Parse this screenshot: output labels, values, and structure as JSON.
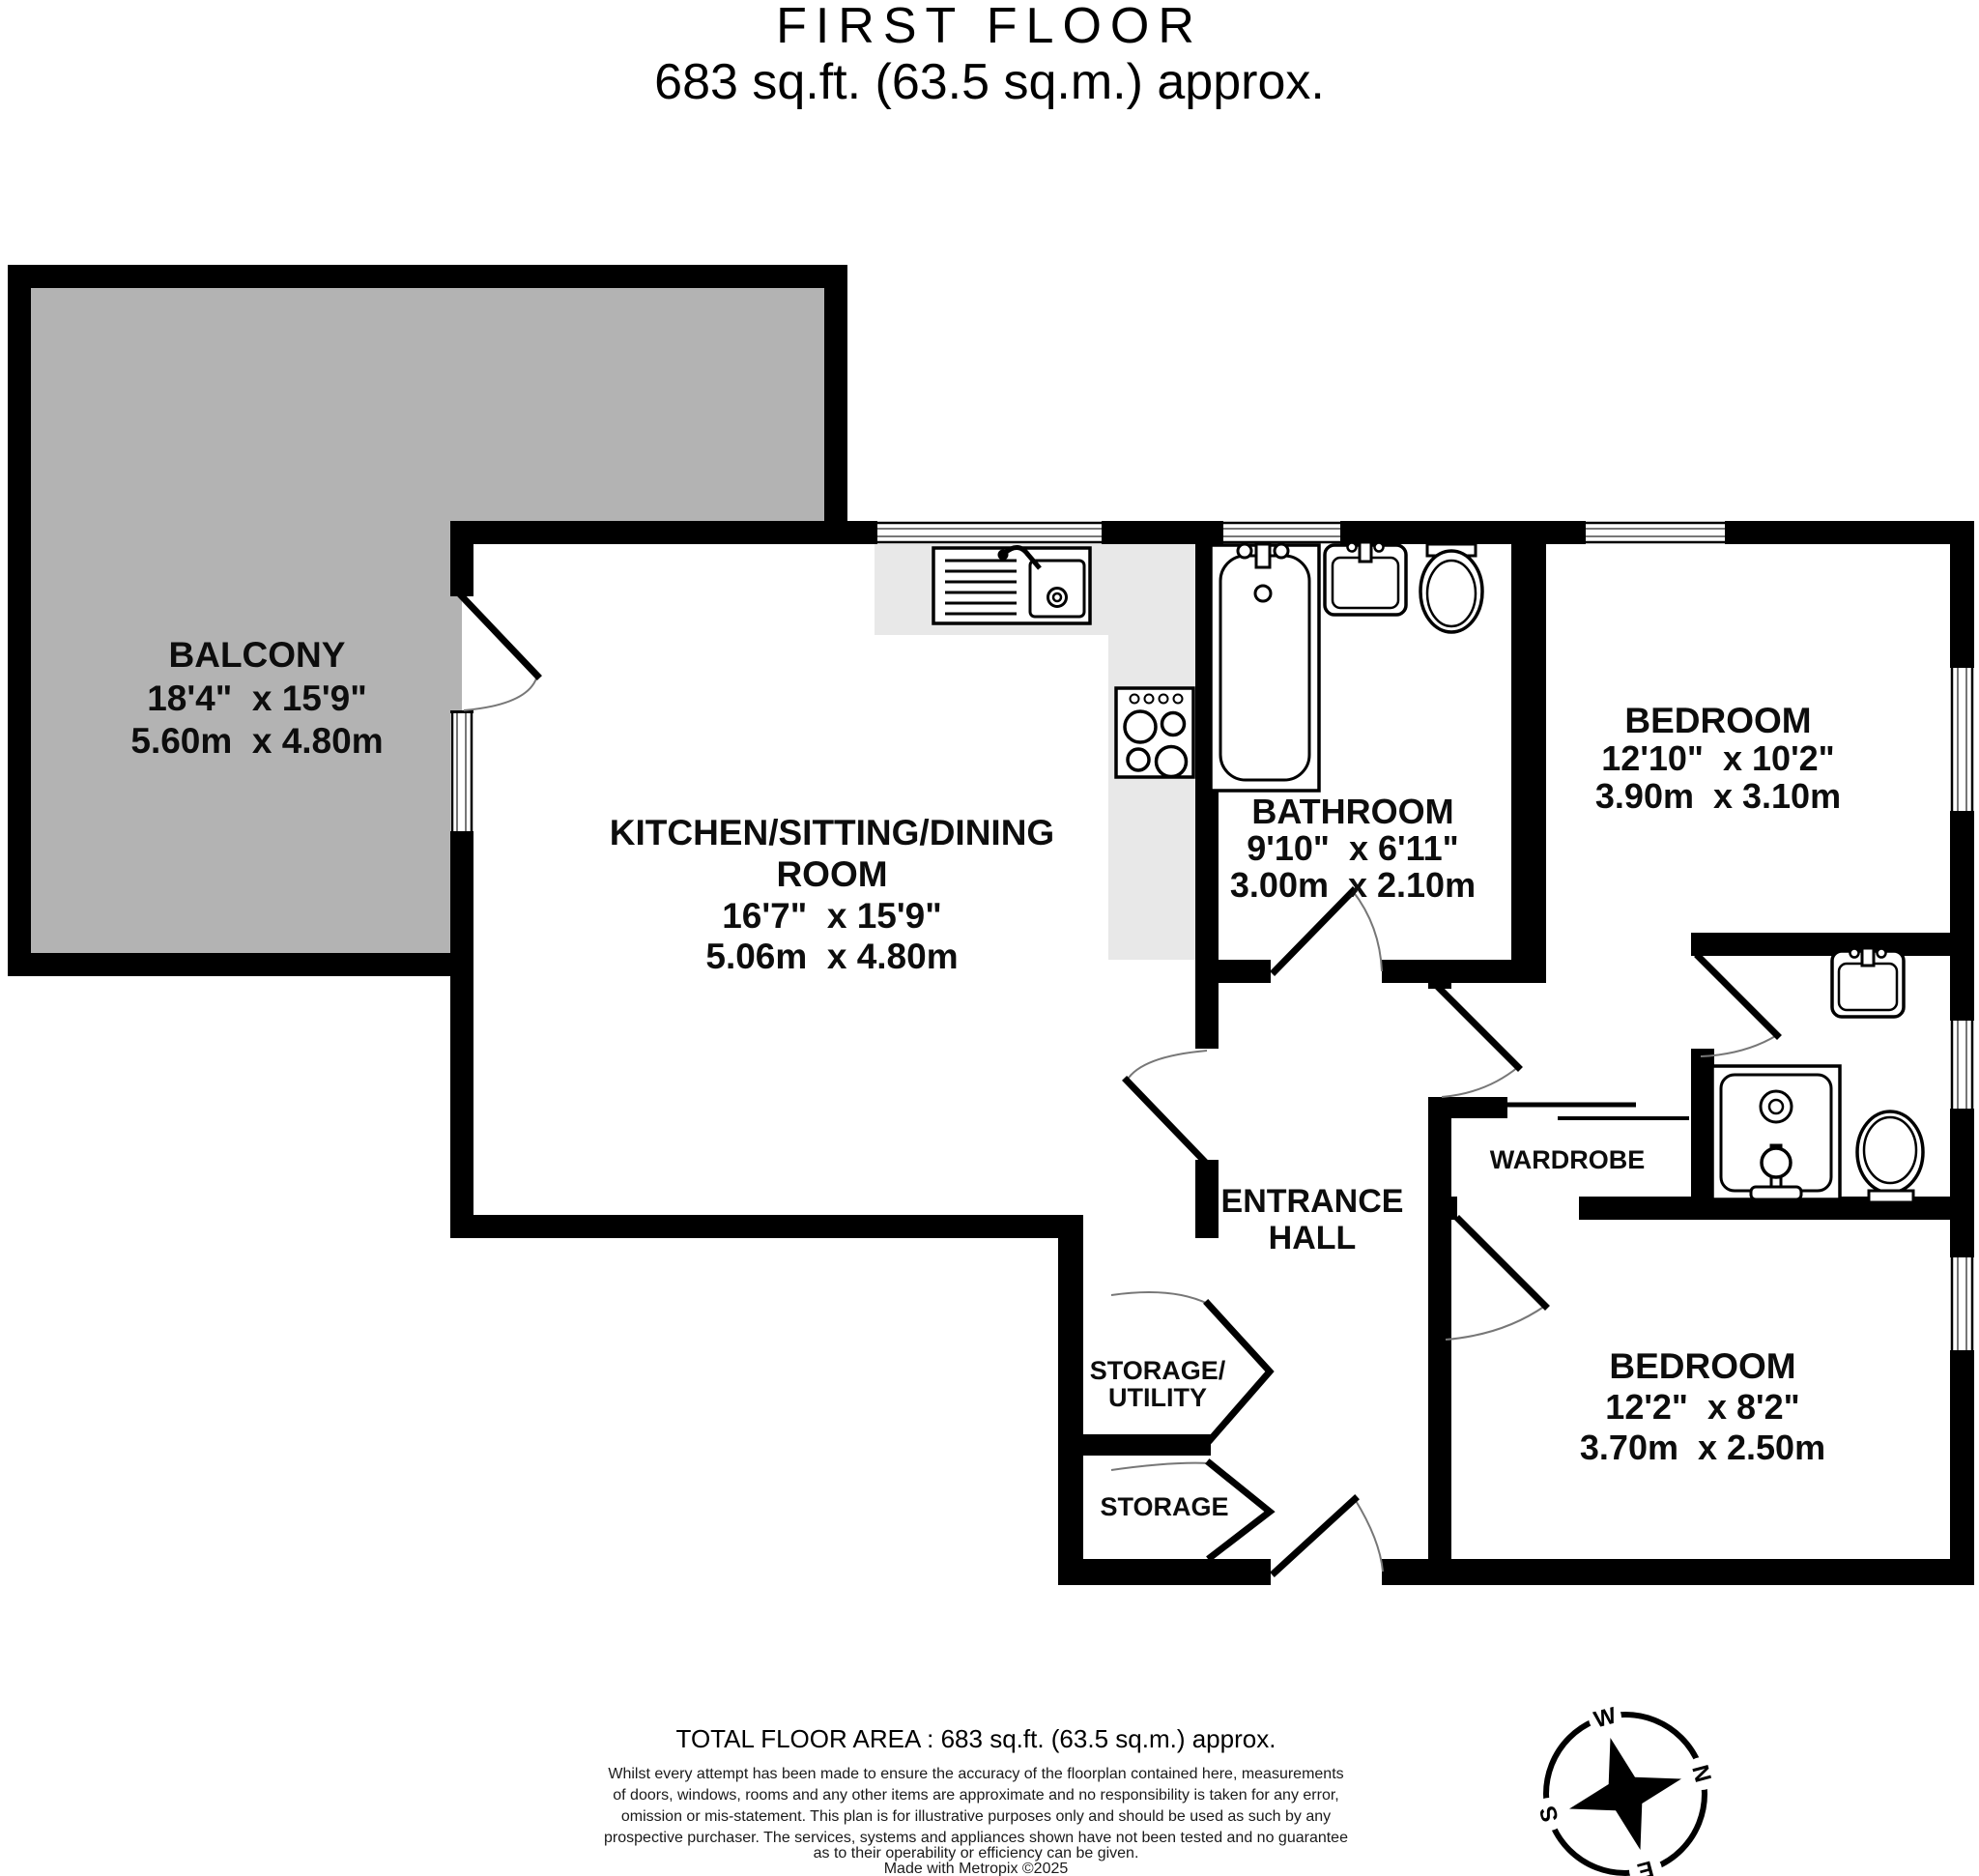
{
  "title": {
    "line1": "FIRST FLOOR",
    "line2": "683 sq.ft. (63.5 sq.m.) approx."
  },
  "rooms": {
    "balcony": {
      "name": "BALCONY",
      "imperial": "18'4\"  x 15'9\"",
      "metric": "5.60m  x 4.80m"
    },
    "kitchen": {
      "name_line1": "KITCHEN/SITTING/DINING",
      "name_line2": "ROOM",
      "imperial": "16'7\"  x 15'9\"",
      "metric": "5.06m  x 4.80m"
    },
    "bathroom": {
      "name": "BATHROOM",
      "imperial": "9'10\"  x 6'11\"",
      "metric": "3.00m  x 2.10m"
    },
    "bedroom1": {
      "name": "BEDROOM",
      "imperial": "12'10\"  x 10'2\"",
      "metric": "3.90m  x 3.10m"
    },
    "bedroom2": {
      "name": "BEDROOM",
      "imperial": "12'2\"  x 8'2\"",
      "metric": "3.70m  x 2.50m"
    },
    "entrance_hall": {
      "line1": "ENTRANCE",
      "line2": "HALL"
    },
    "wardrobe": {
      "name": "WARDROBE"
    },
    "storage_utility": {
      "line1": "STORAGE/",
      "line2": "UTILITY"
    },
    "storage": {
      "name": "STORAGE"
    }
  },
  "footer": {
    "total_area": "TOTAL FLOOR AREA : 683 sq.ft. (63.5 sq.m.) approx.",
    "disclaimer_lines": [
      "Whilst every attempt has been made to ensure the accuracy of the floorplan contained here, measurements",
      "of doors, windows, rooms and any other items are approximate and no responsibility is taken for any error,",
      "omission or mis-statement. This plan is for illustrative purposes only and should be used as such by any",
      "prospective purchaser. The services, systems and appliances shown have not been tested and no guarantee",
      "as to their operability or efficiency can be given."
    ],
    "credit": "Made with Metropix ©2025"
  },
  "compass": {
    "north": "N",
    "east": "E",
    "south": "S",
    "west": "W"
  },
  "colors": {
    "balcony_fill": "#b3b3b3",
    "counter_fill": "#e8e8e8",
    "wall": "#000000",
    "door_arc": "#777777"
  }
}
